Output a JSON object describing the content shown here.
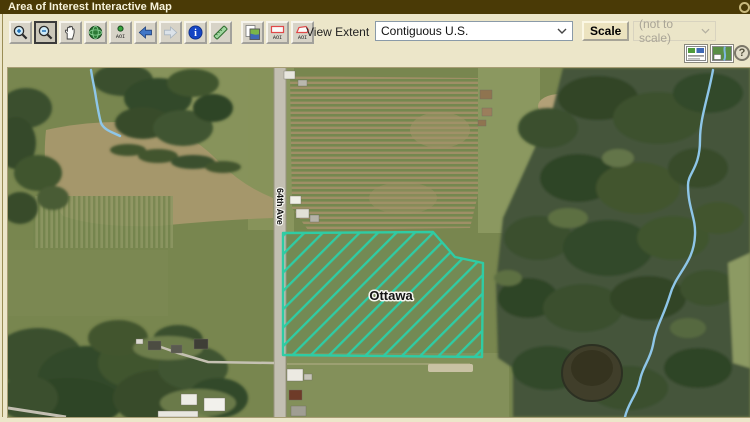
{
  "window": {
    "title": "Area of Interest Interactive Map"
  },
  "toolbar": {
    "buttons": [
      {
        "name": "zoom-in"
      },
      {
        "name": "zoom-out",
        "state": "active"
      },
      {
        "name": "pan"
      },
      {
        "name": "world-extent"
      },
      {
        "name": "zoom-to-aoi"
      },
      {
        "name": "previous-view"
      },
      {
        "name": "next-view",
        "state": "disabled"
      },
      {
        "name": "identify"
      },
      {
        "name": "measure"
      },
      {
        "name": "copy-map"
      },
      {
        "name": "define-aoi-rectangle"
      },
      {
        "name": "define-aoi-polygon"
      }
    ],
    "aoi_text": "AOI",
    "identify_glyph": "i",
    "view_extent_label": "View Extent",
    "view_extent_value": "Contiguous U.S.",
    "scale_button": "Scale",
    "scale_status": "(not to scale)"
  },
  "secondary_toolbar": {
    "icons": [
      {
        "name": "legend-panel"
      },
      {
        "name": "map-panel"
      }
    ],
    "help_glyph": "?"
  },
  "map": {
    "aoi_label": "Ottawa",
    "road_label": "64th Ave",
    "colors": {
      "aoi_hatch": "#2fcca4",
      "stream": "#8ec6e8",
      "field_base": "#78864f",
      "forest": "#3a4f2d",
      "road": "#c3bfb2"
    }
  },
  "colors": {
    "titlebar_bg": "#4a3a06",
    "panel_bg": "#ece6c9",
    "button_face": "#d7d3c7",
    "select_border": "#8a9aa8"
  }
}
